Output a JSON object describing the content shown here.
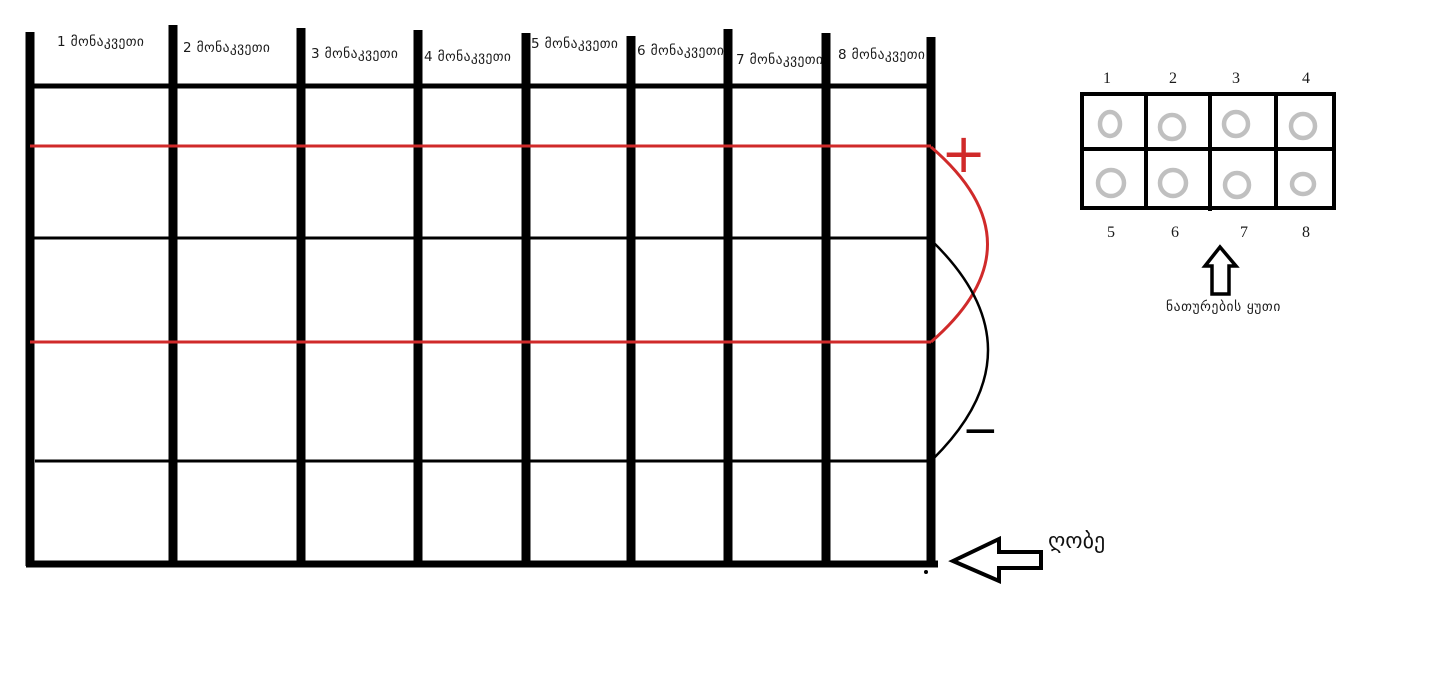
{
  "colors": {
    "line_black": "#000000",
    "wire_red": "#d02a2a",
    "bulb_ring_gray": "#c0c0c0",
    "text": "#1b1b1b"
  },
  "fence": {
    "label": "ღობე",
    "sections": [
      "1 მონაკვეთი",
      "2 მონაკვეთი",
      "3 მონაკვეთი",
      "4 მონაკვეთი",
      "5 მონაკვეთი",
      "6 მონაკვეთი",
      "7 მონაკვეთი",
      "8 მონაკვეთი"
    ]
  },
  "wires": {
    "plus_sign": "+",
    "minus_sign": "−"
  },
  "lightbox": {
    "caption": "ნათურების ყუთი",
    "top_numbers": [
      "1",
      "2",
      "3",
      "4"
    ],
    "bottom_numbers": [
      "5",
      "6",
      "7",
      "8"
    ]
  }
}
